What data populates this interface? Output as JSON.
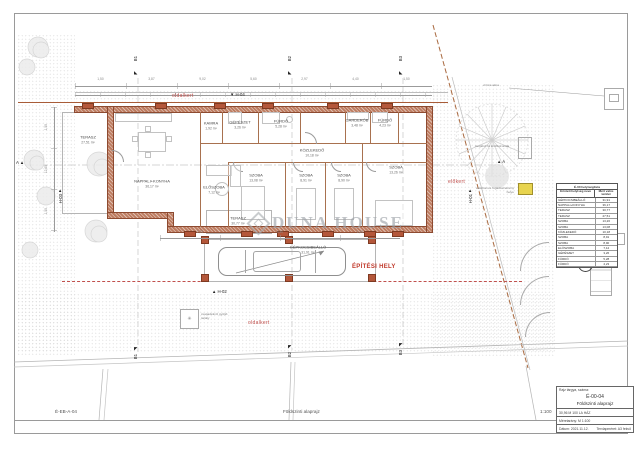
{
  "sheet": {
    "footer": {
      "code": "É-EB-A-04",
      "title": "Földszinti alaprajz",
      "scale": "1:100"
    },
    "title_block": {
      "label": "Rajz tárgya, száma:",
      "number": "É-00-04",
      "title": "Földszinti alaprajz",
      "project": "30,96 M 100 LA HÁZ",
      "scale_label": "Méretarány:",
      "scale": "M 1:100",
      "date_label": "Dátum:",
      "date": "2021.11.12.",
      "paper_label": "Tervlapméret:",
      "paper": "A3 fekvő"
    }
  },
  "site": {
    "oldalkert_top": "oldalkert",
    "oldalkert_bottom": "oldalkert",
    "elokert": "előkert",
    "epitesi_hely": "ÉPÍTÉSI HELY",
    "annotations": {
      "water_meter": "vízóra akna",
      "tree": "meglévő fa lombkoronája",
      "electric1": "elektromos fogadószekrény",
      "electric2": "helye",
      "legend": "csapadékvíz gyűjtő tartály"
    }
  },
  "markers": {
    "b1": "B1",
    "b2": "B2",
    "b3": "B3",
    "a": "A",
    "h01": "H-01",
    "h02": "H-02",
    "h03": "H-03",
    "h04": "H-04"
  },
  "watermark": {
    "brand": "DUNA HOUSE"
  },
  "rooms": [
    {
      "name": "TERASZ",
      "area": "27,51 m²"
    },
    {
      "name": "NAPPALI+KONYHA",
      "area": "36,17 m²"
    },
    {
      "name": "ELŐSZOBA",
      "area": "7,12 m²"
    },
    {
      "name": "KAMRA",
      "area": "1,92 m²"
    },
    {
      "name": "GÉPÉSZET",
      "area": "3,26 m²"
    },
    {
      "name": "FÜRDŐ",
      "area": "5,28 m²"
    },
    {
      "name": "KÖZLEKEDŐ",
      "area": "10,18 m²"
    },
    {
      "name": "GARDERÓB",
      "area": "3,48 m²"
    },
    {
      "name": "FÜRDŐ",
      "area": "4,23 m²"
    },
    {
      "name": "SZOBA",
      "area": "13,08 m²"
    },
    {
      "name": "SZOBA",
      "area": "8,91 m²"
    },
    {
      "name": "SZOBA",
      "area": "8,90 m²"
    },
    {
      "name": "SZOBA",
      "area": "13,26 m²"
    },
    {
      "name": "TERASZ",
      "area": "30,77 m²"
    },
    {
      "name": "GÉPKOCSIBEÁLLÓ",
      "area": "31,91 m²"
    }
  ],
  "room_table": {
    "title": "É-00 helyiséglista",
    "col1": "Érintett helyiség neve",
    "col2": "Mért valós terület",
    "rows": [
      [
        "GÉPKOCSIBEÁLLÓ",
        "31,91"
      ],
      [
        "NAPPALI+KONYHA",
        "36,17"
      ],
      [
        "TERASZ",
        "30,77"
      ],
      [
        "TERASZ",
        "27,51"
      ],
      [
        "SZOBA",
        "13,26"
      ],
      [
        "SZOBA",
        "13,08"
      ],
      [
        "KÖZLEKEDŐ",
        "10,18"
      ],
      [
        "SZOBA",
        "8,91"
      ],
      [
        "SZOBA",
        "8,90"
      ],
      [
        "ELŐSZOBA",
        "7,12"
      ],
      [
        "GÉPÉSZET",
        "3,26"
      ],
      [
        "FÜRDŐ",
        "5,28"
      ],
      [
        "FÜRDŐ",
        "4,23"
      ]
    ]
  },
  "compass": {
    "north": "É",
    "arrow": "↑"
  },
  "dimensions": {
    "top": [
      "1,50",
      "3,87",
      "9,02",
      "5,60",
      "2,97",
      "4,40",
      "1,50"
    ],
    "left": [
      "1,50",
      "12,65",
      "1,50"
    ],
    "bottom": [
      "2,23",
      "4,40",
      "1,50"
    ]
  }
}
